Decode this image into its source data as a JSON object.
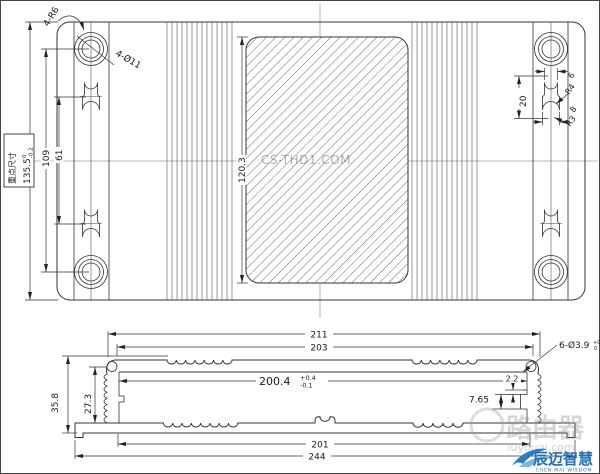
{
  "top_view": {
    "corner_label": "4-R6",
    "holes_label": "4-Ø11",
    "key_dim": {
      "caption": "重点尺寸",
      "value": "135.5",
      "tol_upper": "0",
      "tol_lower": "-0.2"
    },
    "dim_hole_span": "109",
    "dim_slot_span": "61",
    "dim_hatch_height": "120.3",
    "slot_detail": {
      "dim_height": "20",
      "dim_top_width": "6",
      "radius_bottom": "R4",
      "dim_bottom_width": "8",
      "radius_top": "R3"
    }
  },
  "section_view": {
    "dim_overall_width": "211",
    "dim_cover_width": "203",
    "dim_inner_width": {
      "value": "200.4",
      "tol_upper": "+0.4",
      "tol_lower": "-0.1"
    },
    "dim_total_height": "35.8",
    "dim_cavity_height": "27.3",
    "dim_step": "7.65",
    "dim_lip": "2.2",
    "dim_base_inner_width": "201",
    "dim_base_width": "244",
    "screw_holes": {
      "value": "6-Ø3.9",
      "tol_upper": "+0.1",
      "tol_lower": "0"
    }
  },
  "watermarks": {
    "center": "CS-THD1.COM",
    "brand_cn": "路由器",
    "brand_url": "luyouqi.com"
  },
  "logo": {
    "name_cn": "辰迈智慧",
    "name_en": "CHEN MAI WISDOM",
    "color": "#2470b5"
  }
}
